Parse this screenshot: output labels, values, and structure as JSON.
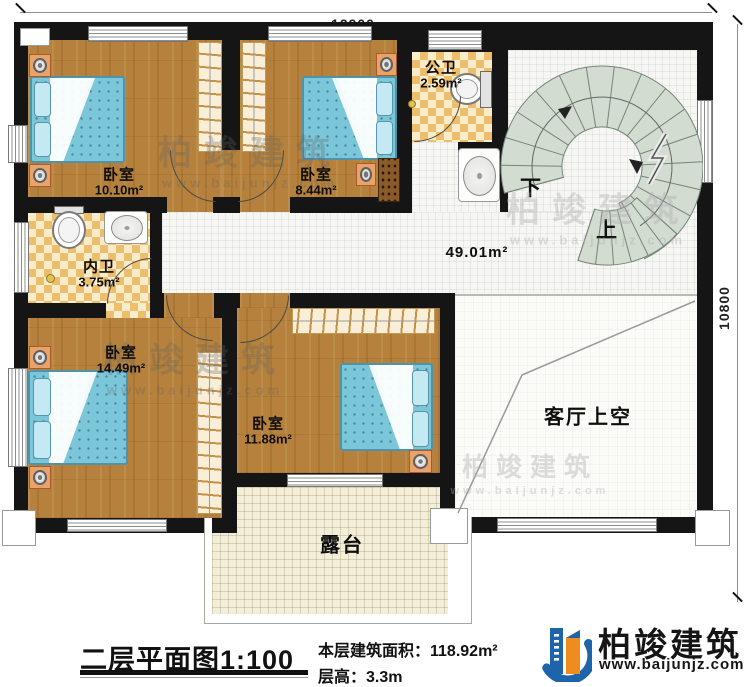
{
  "dimensions": {
    "width": "12900",
    "height": "10800"
  },
  "rooms": {
    "bedroom1": {
      "label": "卧室",
      "area": "10.10m²"
    },
    "bedroom2": {
      "label": "卧室",
      "area": "8.44m²"
    },
    "public_bath": {
      "label": "公卫",
      "area": "2.59m²"
    },
    "inner_bath": {
      "label": "内卫",
      "area": "3.75m²"
    },
    "bedroom3": {
      "label": "卧室",
      "area": "14.49m²"
    },
    "bedroom4": {
      "label": "卧室",
      "area": "11.88m²"
    },
    "hall": {
      "area": "49.01m²"
    },
    "living_void": {
      "label": "客厅上空"
    },
    "terrace": {
      "label": "露台"
    }
  },
  "stairs": {
    "down_label": "下",
    "up_label": "上"
  },
  "title_block": {
    "plan_title": "二层平面图",
    "plan_scale": "1:100",
    "floor_area_label": "本层建筑面积：",
    "floor_area_value": "118.92m²",
    "floor_height_label": "层高：",
    "floor_height_value": "3.3m"
  },
  "brand": {
    "name": "柏竣建筑",
    "website": "www.baijunjz.com"
  },
  "watermark": {
    "name": "柏竣建筑",
    "website": "www.baijunjz.com"
  },
  "colors": {
    "wall": "#151515",
    "wood": "#b5813c",
    "tile_accent": "#edbf6d",
    "bed": "#7cc6da",
    "stair": "#d3dcd1",
    "terrace": "#f2eeda",
    "brand_blue": "#1e64aa",
    "brand_orange": "#f08c1e"
  }
}
